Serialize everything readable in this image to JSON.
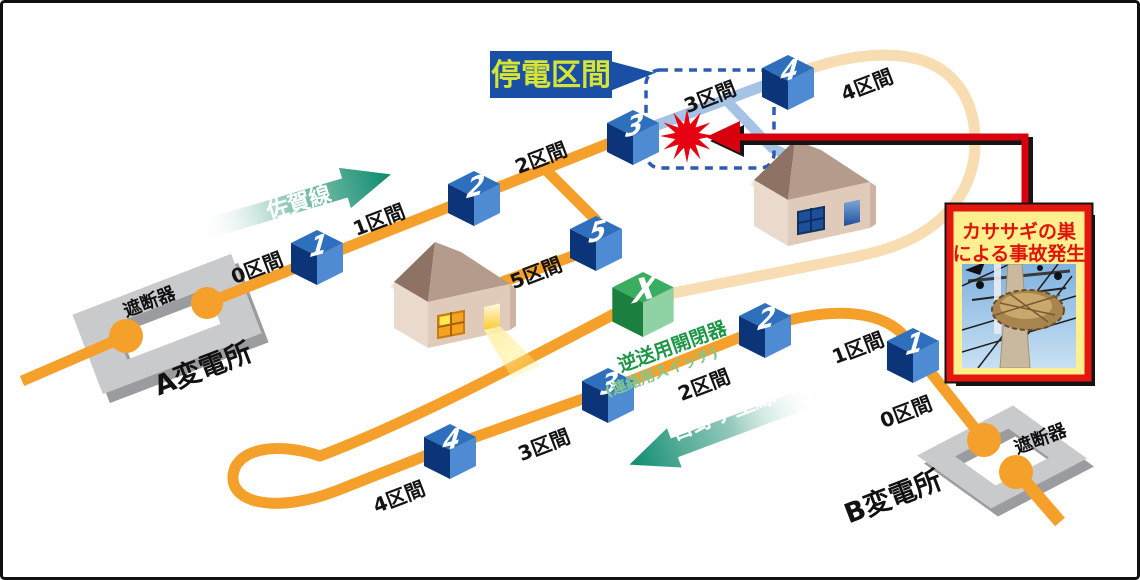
{
  "callout": {
    "label": "停電区間"
  },
  "accident": {
    "line1": "カササギの巣",
    "line2": "による事故発生"
  },
  "tie_switch": {
    "symbol": "X",
    "name": "逆送用開閉器",
    "alias": "(連絡用スイッチ)"
  },
  "saga": {
    "name": "佐賀線",
    "substation": "A変電所",
    "breaker": "遮断器",
    "switches": [
      "1",
      "2",
      "3",
      "4",
      "5"
    ],
    "sections": [
      "0区間",
      "1区間",
      "2区間",
      "3区間",
      "4区間",
      "5区間"
    ]
  },
  "yoshinogari": {
    "name": "吉野ヶ里線",
    "substation": "B変電所",
    "breaker": "遮断器",
    "switches": [
      "1",
      "2",
      "3",
      "4"
    ],
    "sections": [
      "0区間",
      "1区間",
      "2区間",
      "3区間",
      "4区間"
    ]
  },
  "colors": {
    "energized_line": "#F5A02B",
    "dead_line_pale": "#F8DCB2",
    "outage_line_blue": "#A6C2E4",
    "switch_cube_blue": "#2E6FBE",
    "tie_cube_green": "#3BAD60",
    "direction_arrow_teal": "#0E8A6D",
    "callout_bg": "#1950A5",
    "callout_text": "#D6E435",
    "fault_red": "#E60012",
    "arrow_red": "#D6000F",
    "accident_box_bg": "#FFEF8E",
    "accident_border": "#E3170D",
    "accident_text": "#E0140A",
    "substation_plate": "#C9CACC"
  }
}
